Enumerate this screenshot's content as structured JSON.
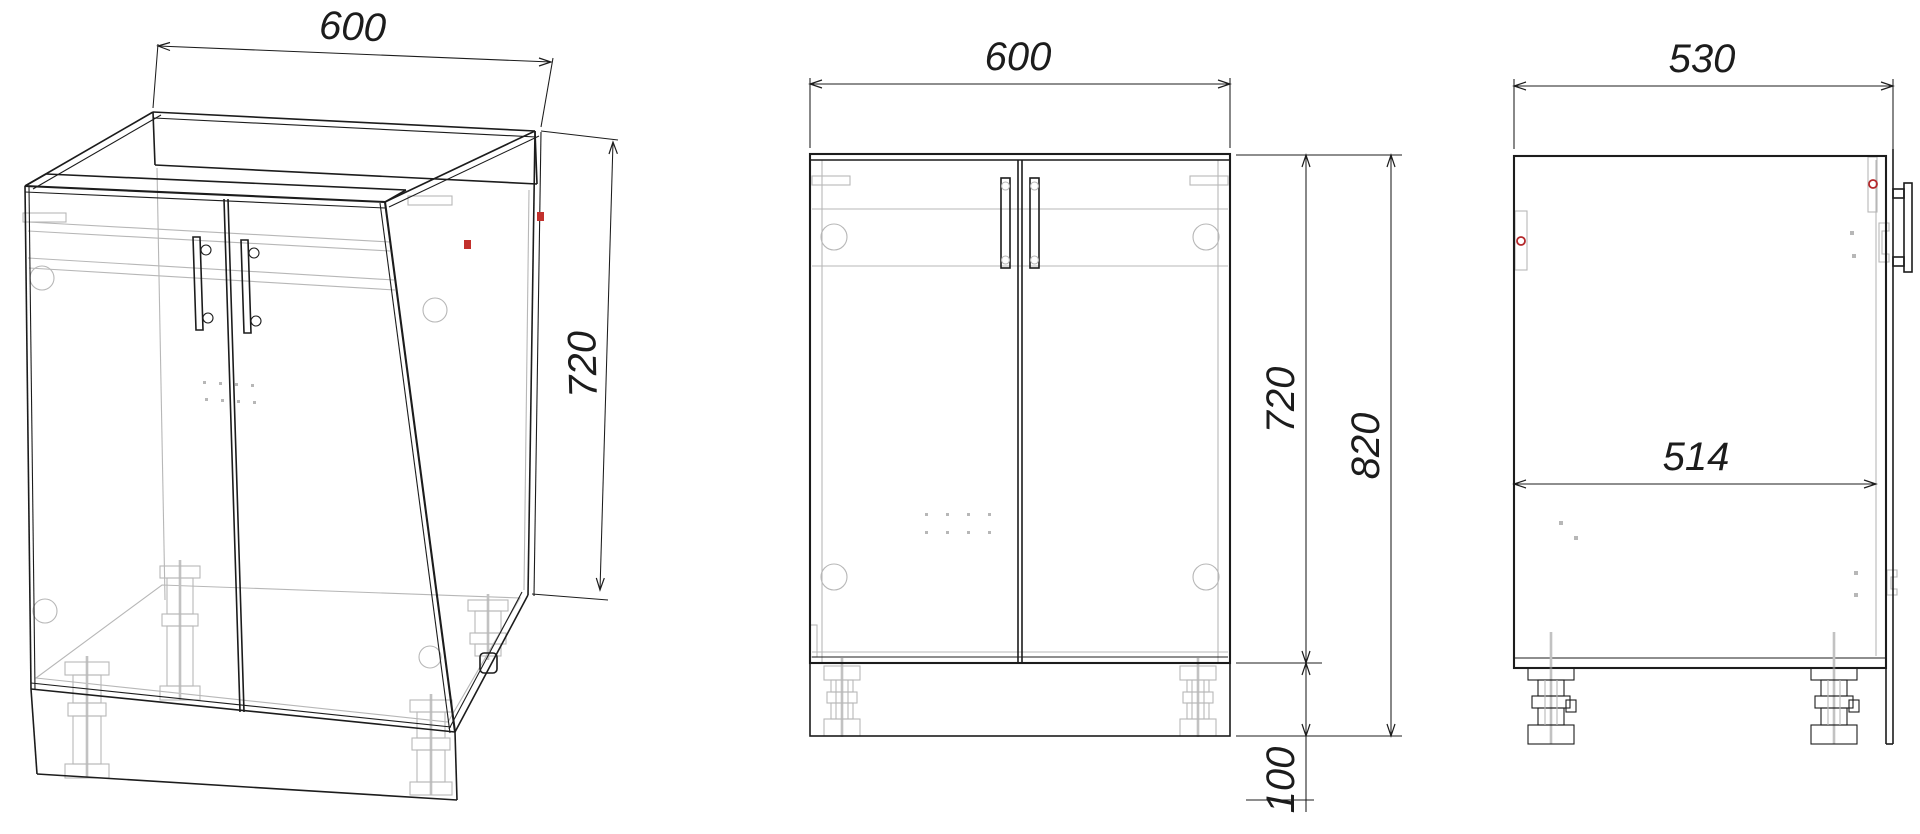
{
  "drawing": {
    "kind": "furniture technical drawing, 3 views",
    "subject": "two-door sink base cabinet with adjustable legs",
    "views": {
      "isometric": {
        "width": "600",
        "height": "720"
      },
      "front": {
        "width": "600",
        "body_height": "720",
        "total_height": "820",
        "plinth_height": "100"
      },
      "side": {
        "depth": "530",
        "inner_depth": "514"
      }
    },
    "colors": {
      "line": "#1c1c1c",
      "hidden_line": "#b7b7b7",
      "accent_red": "#c2302c",
      "background": "#ffffff"
    }
  }
}
